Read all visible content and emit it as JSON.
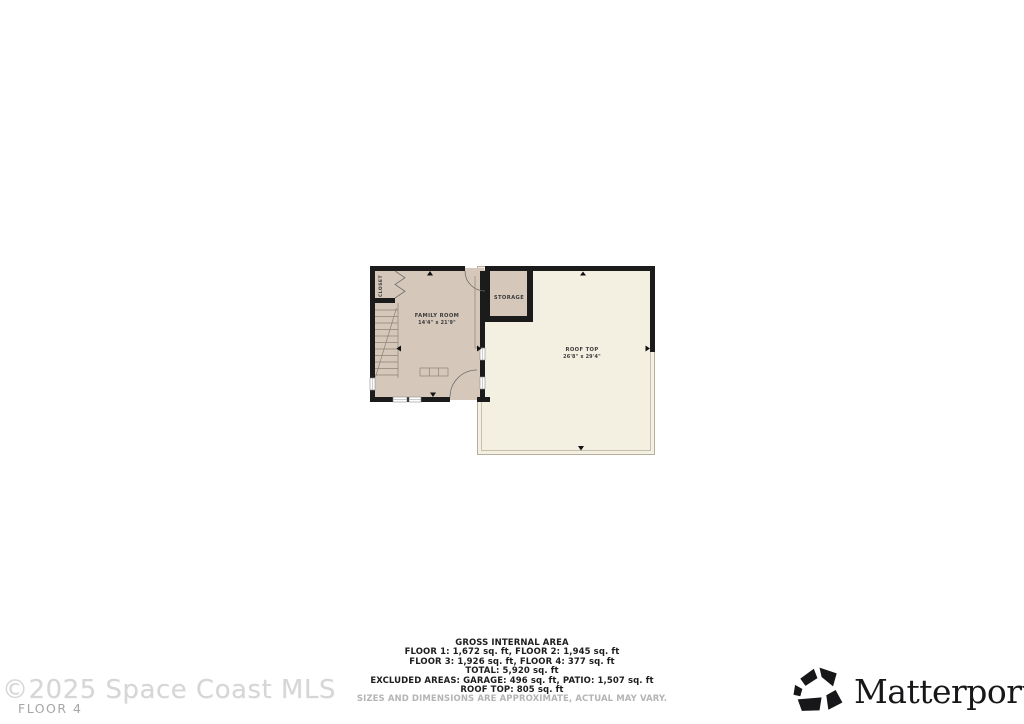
{
  "plan": {
    "rooms": {
      "closet": {
        "label": "CLOSET"
      },
      "family_room": {
        "label": "FAMILY ROOM",
        "dims": "14'4\" x 21'9\""
      },
      "storage": {
        "label": "STORAGE"
      },
      "roof_top": {
        "label": "ROOF TOP",
        "dims": "26'8\" x 29'4\""
      }
    },
    "colors": {
      "wall": "#1b1b1b",
      "room_fill": "#d5c8bb",
      "roof_fill": "#f3f0e2"
    }
  },
  "summary": {
    "title": "GROSS INTERNAL AREA",
    "lines": [
      "FLOOR 1: 1,672 sq. ft, FLOOR 2: 1,945 sq. ft",
      "FLOOR 3: 1,926 sq. ft, FLOOR 4: 377 sq. ft",
      "TOTAL: 5,920 sq. ft",
      "EXCLUDED AREAS: GARAGE: 496 sq. ft, PATIO: 1,507 sq. ft",
      "ROOF TOP: 805 sq. ft"
    ],
    "disclaimer": "SIZES AND DIMENSIONS ARE APPROXIMATE, ACTUAL MAY VARY."
  },
  "watermark": {
    "copyright": "©2025 Space Coast MLS",
    "floor": "FLOOR 4"
  },
  "branding": {
    "name": "Matterport"
  }
}
